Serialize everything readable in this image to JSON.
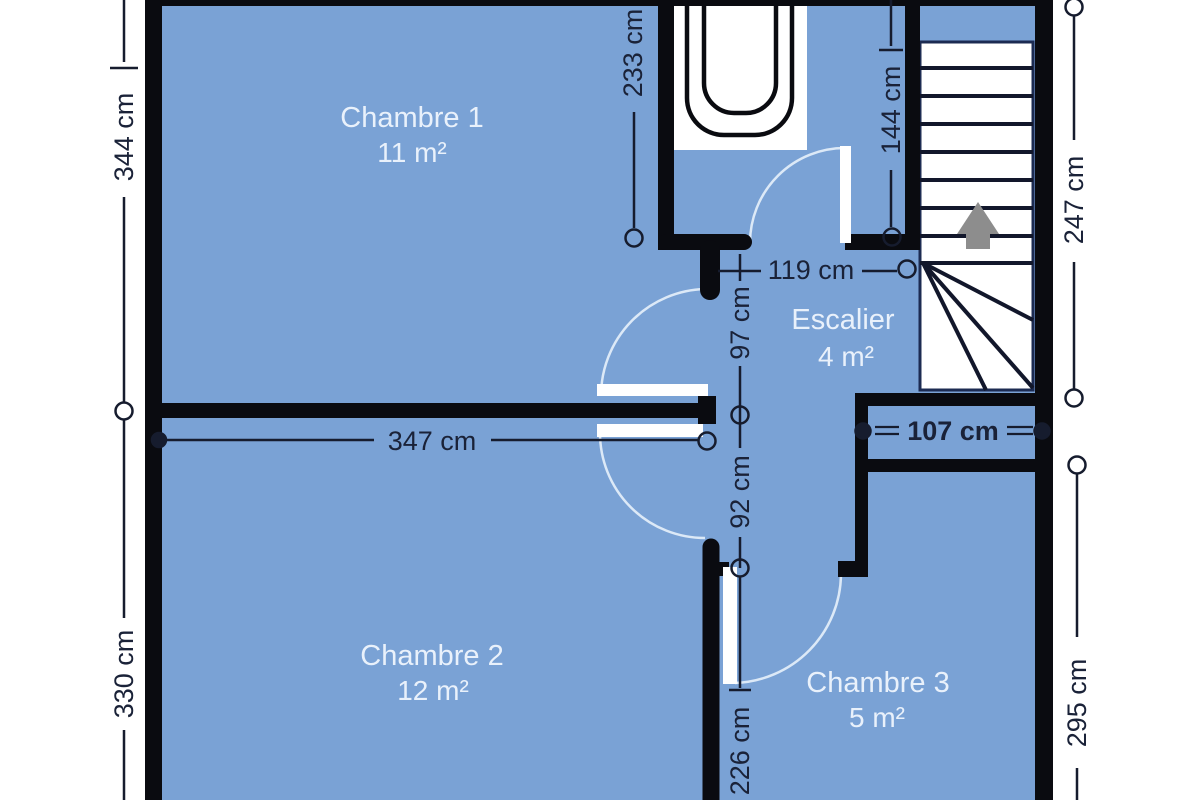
{
  "plan_title": "Floor plan",
  "unit": "cm",
  "rooms": [
    {
      "id": "chambre1",
      "name": "Chambre 1",
      "area": "11 m²"
    },
    {
      "id": "escalier",
      "name": "Escalier",
      "area": "4 m²"
    },
    {
      "id": "chambre2",
      "name": "Chambre 2",
      "area": "12 m²"
    },
    {
      "id": "chambre3",
      "name": "Chambre 3",
      "area": "5 m²"
    }
  ],
  "dimensions": {
    "left_upper": "344 cm",
    "left_lower": "330 cm",
    "chambre1_right": "233 cm",
    "bathroom_right": "144 cm",
    "stairs_right": "247 cm",
    "hallway_top_width": "119 cm",
    "hallway_upper": "97 cm",
    "chambre2_top_width": "347 cm",
    "hallway_middle": "92 cm",
    "landing_width": "107 cm",
    "hallway_lower": "226 cm",
    "chambre3_right": "295 cm"
  },
  "colors": {
    "room_fill": "#7aa2d5",
    "wall": "#0a0b10",
    "dimension": "#161c2e",
    "label": "#e9f1fb",
    "door_arc": "#dce9f7",
    "stair_outline": "#1c2b52",
    "arrow": "#8d8d8d"
  }
}
